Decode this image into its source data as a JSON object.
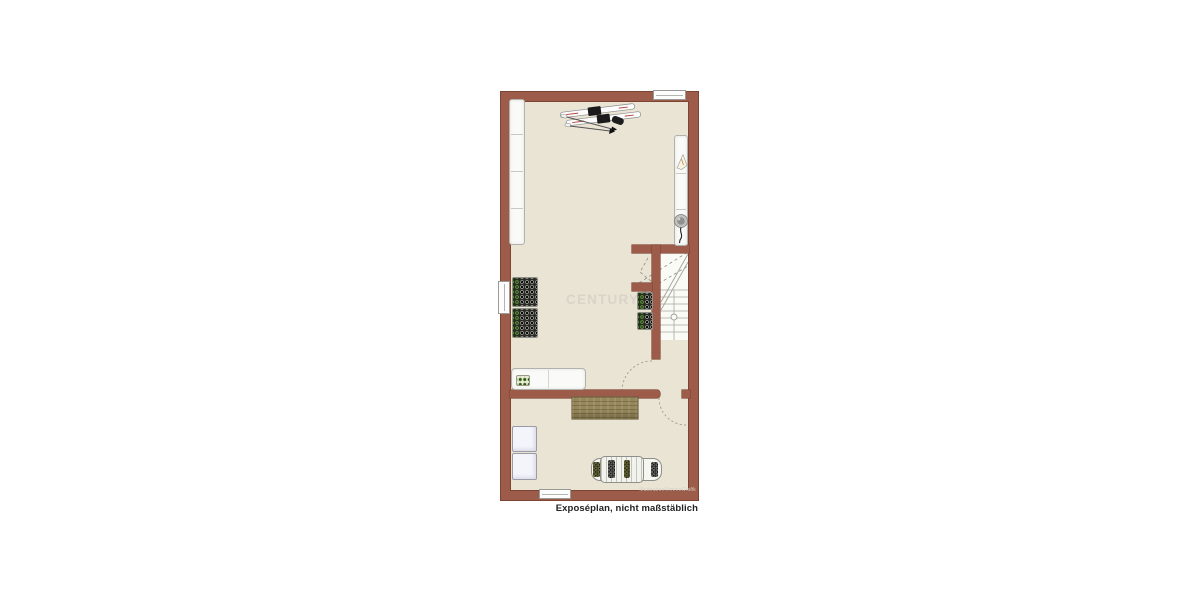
{
  "plan": {
    "watermark": "CENTURY 21",
    "credit": "Illustration©immoGrafik",
    "caption": "Exposéplan, nicht maßstäblich",
    "colors": {
      "canvas": "#ffffff",
      "wall": "#9d5b49",
      "wall-edge": "#7d4434",
      "floor": "#eae4d4",
      "stair-floor": "#fbfbf6",
      "wood": "#96885c",
      "watermark": "#d8d4c8"
    },
    "icons": {
      "skis": "pair of skis with black bindings, top view",
      "ski-poles": "two crossed ski poles with arrow tips",
      "ski-boot": "dark ski boot blob beside skis",
      "flame": "heater flame symbol in utility cabinet",
      "vacuum": "round vacuum cleaner with cord",
      "wine-rack": "dark bottle rack grid, green bottle column",
      "bottle-crate": "small crate with green bottles",
      "stairs": "winder staircase, dashed cut lines, newel circle",
      "door-swing": "dotted quarter-circle door arcs",
      "sled": "wooden sled, top view",
      "windows": "white wall openings with frame line"
    }
  }
}
